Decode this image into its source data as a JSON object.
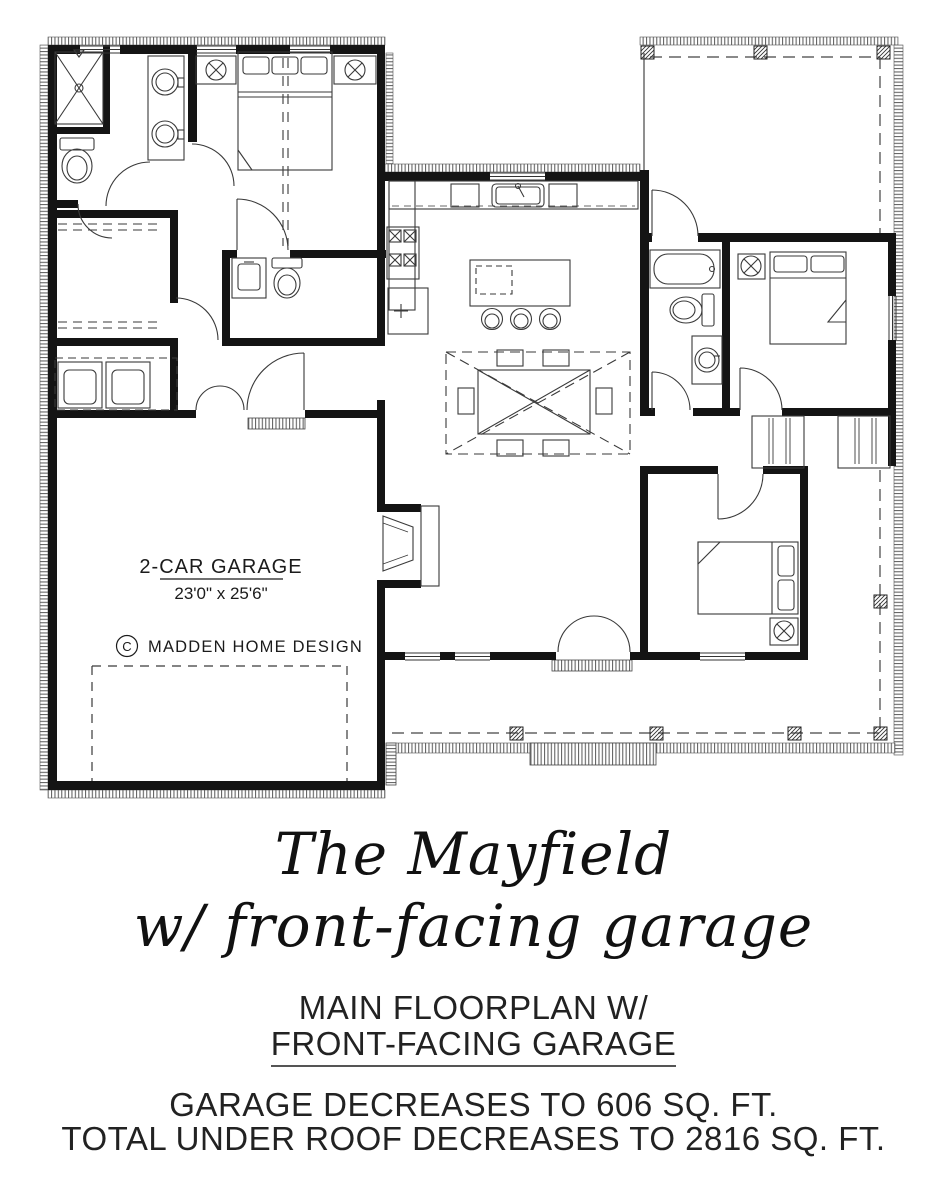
{
  "colors": {
    "ink": "#1b1b1b",
    "line": "#3a3a3a",
    "background": "#ffffff"
  },
  "plan": {
    "garage": {
      "label": "2-CAR GARAGE",
      "dimensions": "23'0\" x 25'6\""
    },
    "copyright": {
      "symbol": "C",
      "text": "MADDEN HOME DESIGN"
    }
  },
  "title": {
    "line1": "The Mayfield",
    "line2": "w/ front-facing garage"
  },
  "subtitle": {
    "line1": "MAIN FLOORPLAN W/",
    "line2": "FRONT-FACING GARAGE"
  },
  "notes": {
    "line1": "GARAGE DECREASES TO 606 SQ. FT.",
    "line2": "TOTAL UNDER ROOF DECREASES TO 2816 SQ. FT."
  }
}
